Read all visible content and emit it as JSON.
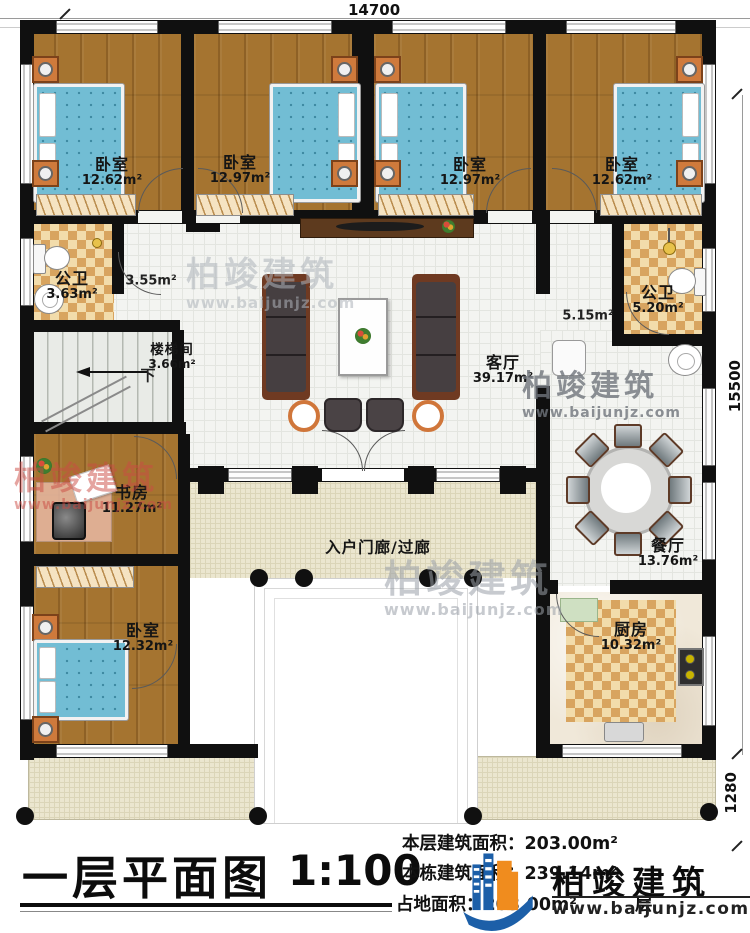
{
  "dimensions": {
    "top": "14700",
    "right": "15500",
    "right_lower": "1280"
  },
  "rooms": {
    "bedroom_tl": {
      "name": "卧室",
      "area": "12.62m²"
    },
    "bedroom_tml": {
      "name": "卧室",
      "area": "12.97m²"
    },
    "bedroom_tmr": {
      "name": "卧室",
      "area": "12.97m²"
    },
    "bedroom_tr": {
      "name": "卧室",
      "area": "12.62m²"
    },
    "bath_left": {
      "name": "公卫",
      "area": "3.63m²"
    },
    "hall_left": {
      "area": "3.55m²"
    },
    "stairwell": {
      "name": "楼梯间",
      "area": "3.66m²",
      "down": "下"
    },
    "living": {
      "name": "客厅",
      "area": "39.17m²"
    },
    "hall_right": {
      "area": "5.15m²"
    },
    "bath_right": {
      "name": "公卫",
      "area": "5.20m²"
    },
    "study": {
      "name": "书房",
      "area": "11.27m²"
    },
    "bedroom_bl": {
      "name": "卧室",
      "area": "12.32m²"
    },
    "porch": {
      "name": "入户门廊/过廊"
    },
    "dining": {
      "name": "餐厅",
      "area": "13.76m²"
    },
    "kitchen": {
      "name": "厨房",
      "area": "10.32m²"
    }
  },
  "title_block": {
    "title": "一层平面图",
    "scale": "1:100",
    "line1_label": "本层建筑面积：",
    "line1_value": "203.00m²",
    "line2_label": "本栋建筑面积：",
    "line2_value": "239.14m²",
    "line3_label": "占地面积：",
    "line3_value": "203.00m²",
    "occluded_char": "层"
  },
  "brand": {
    "name": "柏竣建筑",
    "site": "www.baijunjz.com"
  },
  "watermark": {
    "name": "柏竣建筑",
    "site": "www.baijunjz.com"
  },
  "colors": {
    "wall": "#101010",
    "wood": "#a57430",
    "checker": "#d8a45f",
    "cream": "#ebe6cf",
    "bed_blue": "#72bdd4",
    "brand_blue": "#1c5fa8",
    "brand_orange": "#f08c1e",
    "watermark_red": "#cc4b44"
  }
}
